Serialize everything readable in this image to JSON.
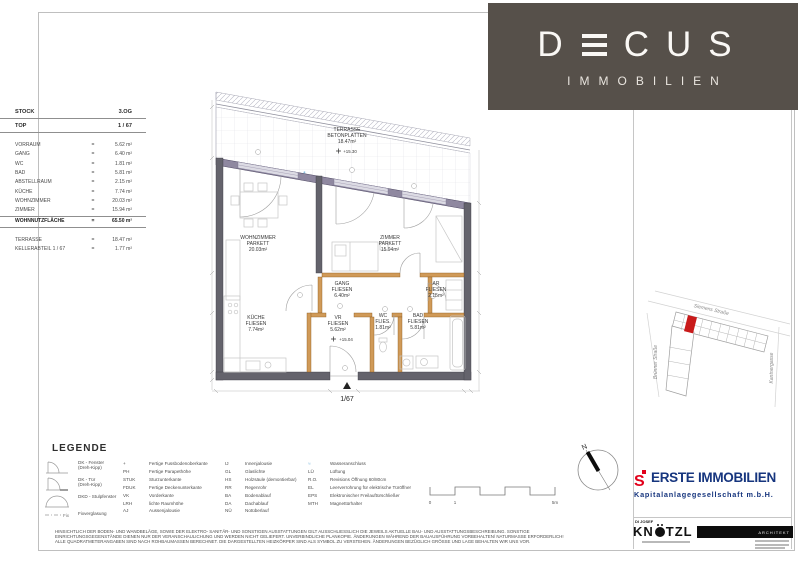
{
  "brand": {
    "name": "DECUS",
    "pre_e": "D",
    "post_e": "CUS",
    "subtitle": "IMMOBILIEN",
    "bg_color": "#56504a"
  },
  "info_panel": {
    "eq": "=",
    "header": [
      {
        "label": "STOCK",
        "value": "3.OG"
      },
      {
        "label": "TOP",
        "value": "1 / 67"
      }
    ],
    "rows": [
      {
        "label": "VORRAUM",
        "value": "5.62 m²"
      },
      {
        "label": "GANG",
        "value": "6.40 m²"
      },
      {
        "label": "WC",
        "value": "1.81 m²"
      },
      {
        "label": "BAD",
        "value": "5.81 m²"
      },
      {
        "label": "ABSTELLRAUM",
        "value": "2.15 m²"
      },
      {
        "label": "KÜCHE",
        "value": "7.74 m²"
      },
      {
        "label": "WOHNZIMMER",
        "value": "20.03 m²"
      },
      {
        "label": "ZIMMER",
        "value": "15.94 m²"
      }
    ],
    "total": {
      "label": "WOHNNUTZFLÄCHE",
      "value": "65.50 m²"
    },
    "extras": [
      {
        "label": "TERRASSE",
        "value": "18.47 m²"
      },
      {
        "label": "KELLERABTEIL  1 / 67",
        "value": "1.77 m²"
      }
    ]
  },
  "floor_plan": {
    "unit_label": "1/67",
    "terrace": {
      "l1": "TERRASSE",
      "l2": "BETONPLATTEN",
      "l3": "18.47m²",
      "level": "+15.30"
    },
    "wohnzimmer": {
      "l1": "WOHNZIMMER",
      "l2": "PARKETT",
      "l3": "20.03m²"
    },
    "zimmer": {
      "l1": "ZIMMER",
      "l2": "PARKETT",
      "l3": "15.94m²"
    },
    "kueche": {
      "l1": "KÜCHE",
      "l2": "FLIESEN",
      "l3": "7.74m²"
    },
    "gang": {
      "l1": "GANG",
      "l2": "FLIESEN",
      "l3": "6.40m²"
    },
    "ar": {
      "l1": "AR",
      "l2": "FLIESEN",
      "l3": "2.15m²"
    },
    "vr": {
      "l1": "VR",
      "l2": "FLIESEN",
      "l3": "5.62m²",
      "level": "+15.04"
    },
    "wc": {
      "l1": "WC",
      "l2": "FLIES.",
      "l3": "1.81m²"
    },
    "bad": {
      "l1": "BAD",
      "l2": "FLIESEN",
      "l3": "5.81m²"
    },
    "colors": {
      "wall_dark": "#64636c",
      "wall_facade": "#8f88a0",
      "wall_interior": "#d09a58"
    }
  },
  "site_map": {
    "street_top": "Siemens Straße",
    "street_left": "Brünner Straße",
    "street_right": "Kantnergasse",
    "highlight_color": "#c91a1a"
  },
  "legend": {
    "title": "LEGENDE",
    "col1": [
      {
        "l1": "DK - Fenster",
        "l2": "(Dreh-Kipp)"
      },
      {
        "l1": "DK - Tür",
        "l2": "(Dreh-Kipp)"
      },
      {
        "l1": "DKD - Stulpfenster",
        "l2": ""
      },
      {
        "l1": "Fixverglasung",
        "l2": "",
        "symbol_label": "Fix"
      }
    ],
    "col2": [
      {
        "abbr": "+",
        "text": "Fertige Fussbodenoberkante"
      },
      {
        "abbr": "PH",
        "text": "Fertige Parapethöhe"
      },
      {
        "abbr": "STUK",
        "text": "Sturzunterkante"
      },
      {
        "abbr": "FDUK",
        "text": "Fertige Deckenunterkante"
      },
      {
        "abbr": "VK",
        "text": "Vorderkante"
      },
      {
        "abbr": "LRH",
        "text": "lichte Raumhöhe"
      },
      {
        "abbr": "AJ",
        "text": "Aussenjalousie"
      }
    ],
    "col3": [
      {
        "abbr": "IJ",
        "text": "Innenjalousie"
      },
      {
        "abbr": "GL",
        "text": "Glaslichte"
      },
      {
        "abbr": "HS",
        "text": "Holzsäule (demontierbar)"
      },
      {
        "abbr": "RR",
        "text": "Regenrohr"
      },
      {
        "abbr": "BA",
        "text": "Bodenablauf"
      },
      {
        "abbr": "DA",
        "text": "Dachablauf"
      },
      {
        "abbr": "NÜ",
        "text": "Notüberlauf"
      }
    ],
    "col4": [
      {
        "abbr": "≈",
        "text": "Wasseranschluss"
      },
      {
        "abbr": "LÜ",
        "text": "Lüftung"
      },
      {
        "abbr": "R.O.",
        "text": "Revisions Öffnung 60/80cm"
      },
      {
        "abbr": "EL",
        "text": "Leerverrohrung für elektrische Türöffner"
      },
      {
        "abbr": "EPS",
        "text": "Elektronischer Freilauftürschließer"
      },
      {
        "abbr": "MTH",
        "text": "Magnettürhalter"
      }
    ]
  },
  "scale_bar": {
    "t0": "0",
    "t1": "1",
    "t2": "5m"
  },
  "compass": {
    "label": "N"
  },
  "erste": {
    "glyph": "S",
    "name": "ERSTE IMMOBILIEN",
    "subtitle": "Kapitalanlagegesellschaft m.b.H.",
    "blue": "#16357e",
    "red": "#e2001a"
  },
  "architect": {
    "prefix": "DI JOSEF",
    "pre_o": "KN",
    "post_o": "TZL",
    "title": "ARCHITEKT"
  },
  "disclaimer": [
    "HINSICHTLICH DER BODEN- UND WANDBELÄGE, SOWIE DER ELEKTRO- SANITÄR- UND SONSTIGEN AUSSTATTUNGEN GILT AUSSCHLIESSLICH DIE JEWEILS AKTUELLE BAU- UND AUSSTATTUNGSBESCHREIBUNG. SONSTIGE",
    "EINRICHTUNGSGEGENSTÄNDE DIENEN NUR DER VERANSCHAULICHUNG UND WERDEN NICHT GELIEFERT. UNVERBINDLICHE PLANKOPIE. ÄNDERUNGEN WÄHREND DER BAUAUSFÜHRUNG VORBEHALTEN/ NATURMASSE ERFORDERLICH!",
    "ALLE QUADRATMETERANGABEN SIND NACH ROHBAUMASSEN BERECHNET. DIE DARGESTELLTEN HEIZKÖRPER SIND ALS SYMBOL ZU VERSTEHEN. ÄNDERUNGEN BEZÜGLICH GRÖSSE UND LAGE BEHALTEN WIR UNS VOR."
  ]
}
